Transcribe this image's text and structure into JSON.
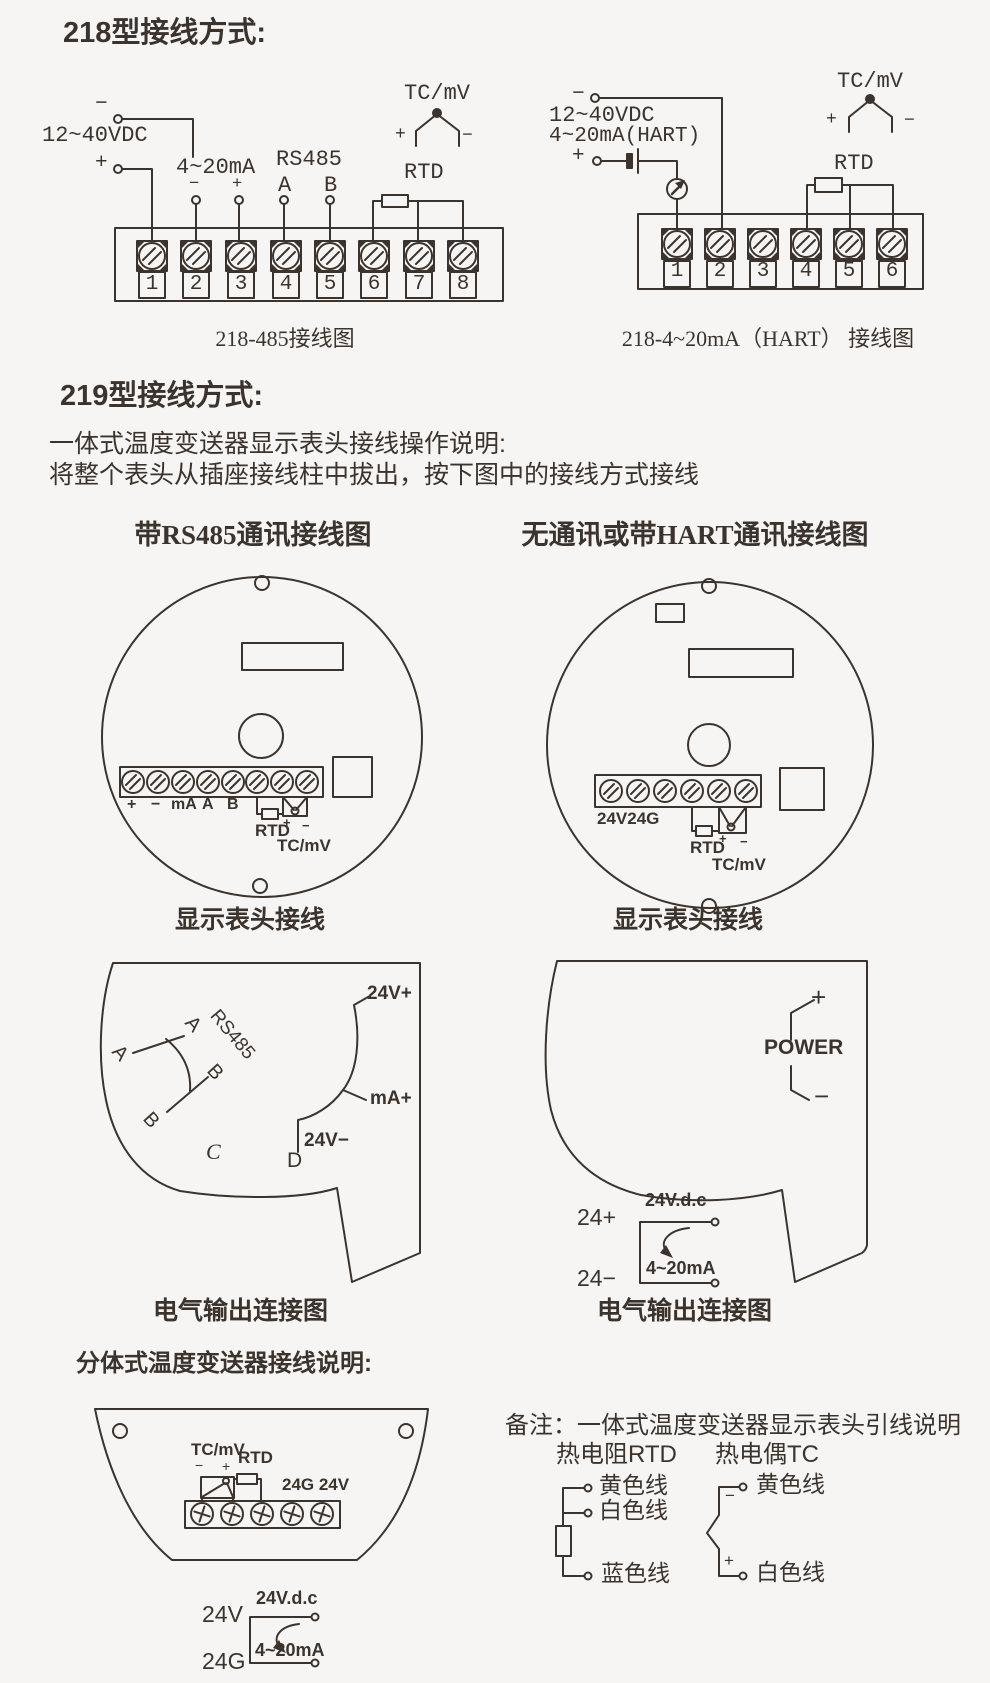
{
  "page": {
    "bg": "#f6f5f3",
    "ink": "#3a3430"
  },
  "s218": {
    "title": "218型接线方式:",
    "left": {
      "minus": "−",
      "plus": "+",
      "power": "12~40VDC",
      "ma": "4~20mA",
      "ma_minus": "−",
      "ma_plus": "+",
      "rs485": "RS485",
      "a": "A",
      "b": "B",
      "tcmv": "TC/mV",
      "tc_plus": "+",
      "tc_minus": "−",
      "rtd": "RTD",
      "terminals": [
        "1",
        "2",
        "3",
        "4",
        "5",
        "6",
        "7",
        "8"
      ],
      "caption": "218-485接线图"
    },
    "right": {
      "minus": "−",
      "plus": "+",
      "power": "12~40VDC",
      "hart": "4~20mA(HART)",
      "tcmv": "TC/mV",
      "tc_plus": "+",
      "tc_minus": "−",
      "rtd": "RTD",
      "terminals": [
        "1",
        "2",
        "3",
        "4",
        "5",
        "6"
      ],
      "caption": "218-4~20mA（HART） 接线图"
    }
  },
  "s219": {
    "title": "219型接线方式:",
    "desc1": "一体式温度变送器显示表头接线操作说明:",
    "desc2": "将整个表头从插座接线柱中拔出，按下图中的接线方式接线",
    "headL": {
      "header": "带RS485通讯接线图",
      "plus": "+",
      "minus": "−",
      "ma": "mA",
      "a": "A",
      "b": "B",
      "rtd": "RTD",
      "rtd_plus": "+",
      "rtd_minus": "−",
      "tcmv": "TC/mV",
      "caption": "显示表头接线"
    },
    "headR": {
      "header": "无通讯或带HART通讯接线图",
      "v24": "24V24G",
      "rtd": "RTD",
      "rtd_plus": "+",
      "rtd_minus": "−",
      "tcmv": "TC/mV",
      "caption": "显示表头接线"
    },
    "outL": {
      "a1": "A",
      "a2": "A",
      "b1": "B",
      "b2": "B",
      "rs485": "RS485",
      "c": "C",
      "d": "D",
      "v_plus": "24V+",
      "ma_plus": "mA+",
      "v_minus": "24V−",
      "caption": "电气输出连接图"
    },
    "outR": {
      "plus": "+",
      "minus": "−",
      "power": "POWER",
      "vdc": "24V.d.c",
      "p24": "24+",
      "m24": "24−",
      "ma": "4~20mA",
      "caption": "电气输出连接图"
    }
  },
  "split": {
    "title": "分体式温度变送器接线说明:",
    "tcmv": "TC/mV",
    "rtd": "RTD",
    "minus": "−",
    "plus": "+",
    "g24v": "24G 24V",
    "v24": "24V",
    "g24": "24G",
    "vdc": "24V.d.c",
    "ma": "4~20mA"
  },
  "note": {
    "title": "备注：一体式温度变送器显示表头引线说明",
    "rtd_head": "热电阻RTD",
    "tc_head": "热电偶TC",
    "rtd_yellow": "黄色线",
    "rtd_white": "白色线",
    "rtd_blue": "蓝色线",
    "tc_minus": "−",
    "tc_plus": "+",
    "tc_yellow": "黄色线",
    "tc_white": "白色线"
  }
}
